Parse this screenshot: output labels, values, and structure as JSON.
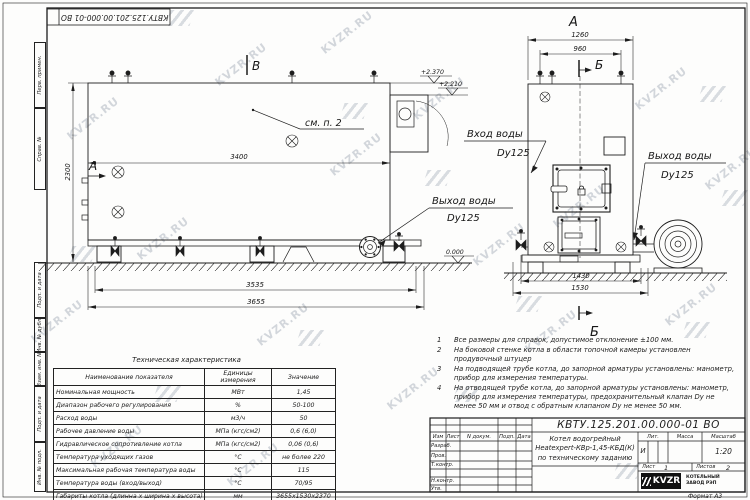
{
  "frame": {
    "stamp_top": "КВТУ.125.201.00.000-01 ВО",
    "format_note": "Формат А3",
    "margin_boxes": {
      "b1": "Перв. примен.",
      "b2": "Справ. №",
      "b3": "Подп. и дата",
      "b4": "Инв. № дубл.",
      "b5": "Взам. инв. №",
      "b6": "Подп. и дата",
      "b7": "Инв. № подл."
    }
  },
  "watermark": {
    "text": "KVZR.RU"
  },
  "drawing": {
    "side_view": {
      "view_label_top": "В",
      "view_label_left": "А",
      "see_note": "см. п. 2",
      "elev_top": "+2.370",
      "elev_mid": "+2.210",
      "elev_zero": "0.000",
      "dim_inner": "3400",
      "dim_height": "2300",
      "dim_frame": "3535",
      "dim_overall": "3655",
      "outlet_line1": "Выход воды",
      "outlet_line2": "Dy125"
    },
    "front_view": {
      "view_label_top": "А",
      "section_label_top": "Б",
      "section_label_bottom": "Б",
      "dim_top_outer": "1260",
      "dim_top_inner": "960",
      "dim_bottom_inner": "1430",
      "dim_bottom_outer": "1530",
      "inlet_line1": "Вход воды",
      "inlet_line2": "Dy125",
      "outlet_line1": "Выход воды",
      "outlet_line2": "Dy125"
    }
  },
  "notes": {
    "items": [
      {
        "num": "1",
        "text": "Все размеры для справок, допустимое отклонение ±100 мм."
      },
      {
        "num": "2",
        "text": "На боковой стенке котла в области топочной камеры установлен продувочный штуцер"
      },
      {
        "num": "3",
        "text": "На  подводящей трубе котла, до запорной арматуры установлены: манометр, прибор для измерения температуры."
      },
      {
        "num": "4",
        "text": "На отводящей трубе котла, до запорной арматуры установлены: манометр, прибор для измерения температуры, предохранительный клапан Dy не менее 50 мм и отвод с обратным клапаном Dy не менее 50 мм."
      }
    ]
  },
  "tech_table": {
    "title": "Техническая характеристика",
    "col_name": "Наименование показателя",
    "col_units": "Единицы измерения",
    "col_value": "Значение",
    "rows": [
      {
        "name": "Номинальная мощность",
        "units": "МВт",
        "value": "1,45"
      },
      {
        "name": "Диапазон рабочего регулирования",
        "units": "%",
        "value": "50-100"
      },
      {
        "name": "Расход воды",
        "units": "м3/ч",
        "value": "50"
      },
      {
        "name": "Рабочее давление воды",
        "units": "МПа (кгс/см2)",
        "value": "0,6 (6,0)"
      },
      {
        "name": "Гидравлическое сопротивление котла",
        "units": "МПа (кгс/см2)",
        "value": "0,06 (0,6)"
      },
      {
        "name": "Температура уходящих газов",
        "units": "°С",
        "value": "не более 220"
      },
      {
        "name": "Максимальная рабочая температура воды",
        "units": "°С",
        "value": "115"
      },
      {
        "name": "Температура воды (вход/выход)",
        "units": "°С",
        "value": "70/95"
      },
      {
        "name": "Габариты котла (длинна х ширина х высота)",
        "units": "мм",
        "value": "3655х1530х2370"
      }
    ]
  },
  "title_block": {
    "doc_number": "КВТУ.125.201.00.000-01 ВО",
    "header_cols": {
      "izm": "Изм",
      "list": "Лист",
      "doc": "N докум.",
      "podp": "Подп.",
      "data": "Дата"
    },
    "rows": {
      "r1": "Разраб.",
      "r2": "Пров.",
      "r3": "Т.контр.",
      "r4": "Н.контр.",
      "r5": "Утв."
    },
    "name_line1": "Котел водогрейный",
    "name_line2": "Heatexpert-КВр-1,45-КБД(К)",
    "name_line3": "по техническому заданию",
    "lit_label": "Лит.",
    "lit_value": "И",
    "mass_label": "Масса",
    "scale_label": "Масштаб",
    "scale_value": "1:20",
    "sheet_label": "Лист",
    "sheet_value": "1",
    "sheets_label": "Листов",
    "sheets_value": "2",
    "logo_text": "KVZR",
    "logo_sub1": "КОТЕЛЬНЫЙ",
    "logo_sub2": "ЗАВОД РЭП"
  }
}
